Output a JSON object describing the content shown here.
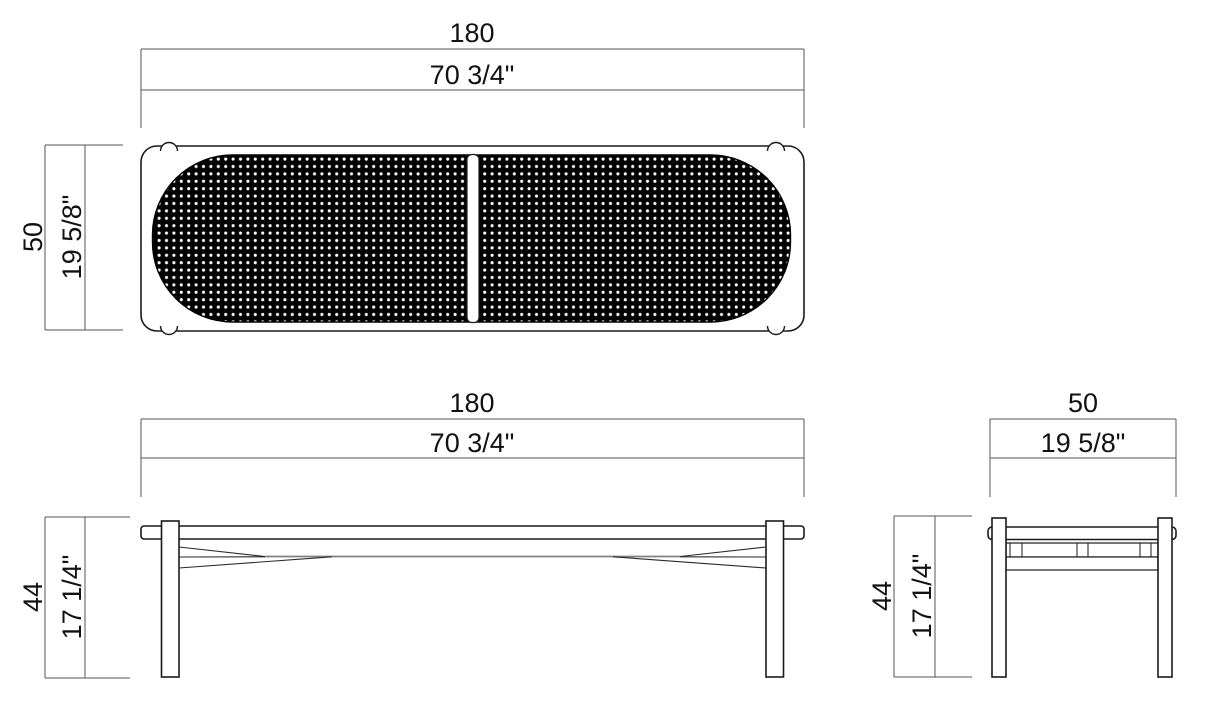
{
  "drawing": {
    "views": {
      "top": {
        "width": {
          "metric": "180",
          "imperial": "70 3/4\""
        },
        "depth": {
          "metric": "50",
          "imperial": "19 5/8\""
        }
      },
      "front": {
        "width": {
          "metric": "180",
          "imperial": "70 3/4\""
        },
        "height": {
          "metric": "44",
          "imperial": "17 1/4\""
        }
      },
      "side": {
        "width": {
          "metric": "50",
          "imperial": "19 5/8\""
        },
        "height": {
          "metric": "44",
          "imperial": "17 1/4\""
        }
      }
    },
    "colors": {
      "line": "#1a1a1a",
      "dimension_line": "#555555",
      "stretcher_gray": "#808080",
      "mesh_fill": "#000000",
      "mesh_dot": "#ffffff",
      "background": "#ffffff"
    }
  }
}
